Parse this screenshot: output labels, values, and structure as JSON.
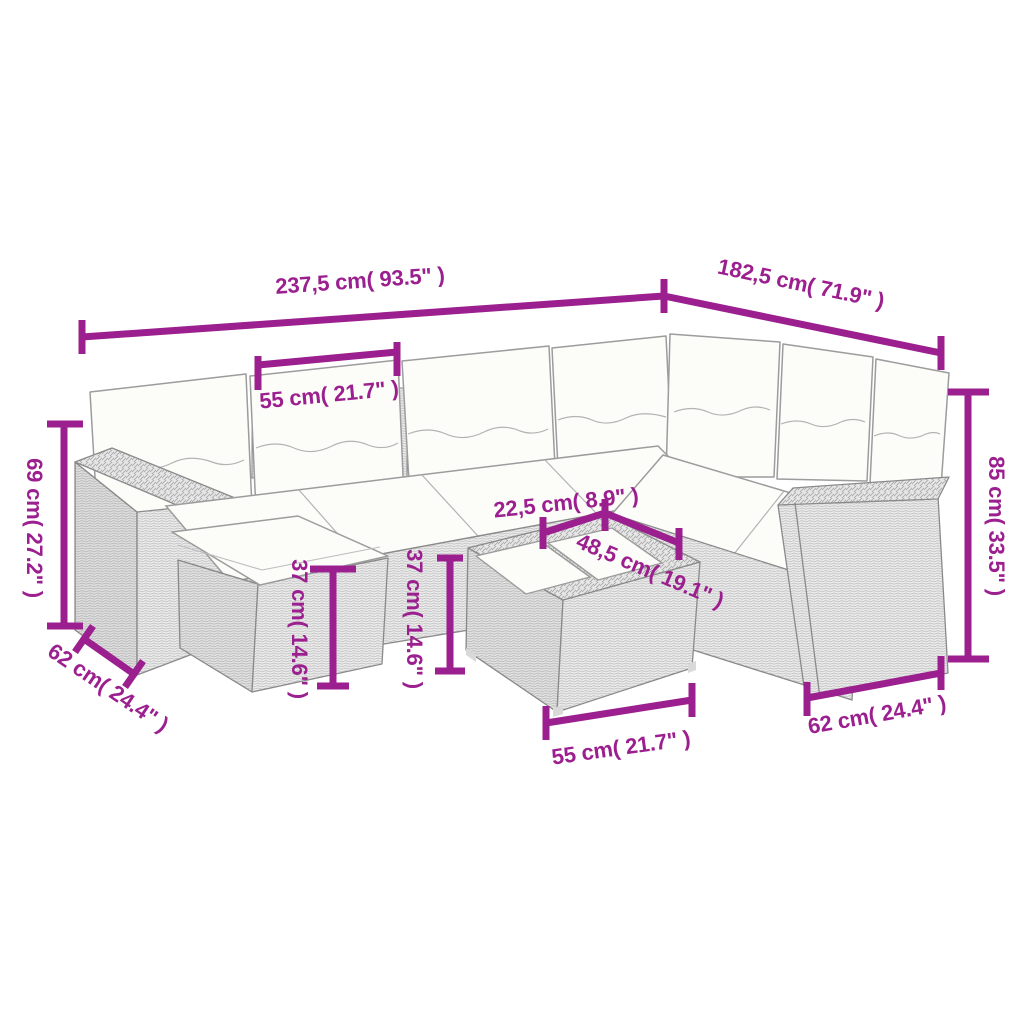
{
  "colors": {
    "accent": "#9b1f8e",
    "line_art_outline": "#8a8a8a",
    "cushion_fill": "#fcfcf9",
    "wicker_fill": "#ededed"
  },
  "dimensions": {
    "overall_width": "237,5 cm( 93.5\" )",
    "overall_depth": "182,5 cm( 71.9\" )",
    "backrest_section_width": "55 cm( 21.7\" )",
    "left_arm_height": "69 cm( 27.2\" )",
    "left_seat_depth": "62 cm( 24.4\" )",
    "footstool_height": "37 cm( 14.6\" )",
    "table_height": "37 cm( 14.6\" )",
    "tabletop_depth": "22,5 cm( 8.9\" )",
    "tabletop_width": "48,5 cm( 19.1\" )",
    "table_width": "55 cm( 21.7\" )",
    "right_back_height": "85 cm( 33.5\" )",
    "right_seat_depth": "62 cm( 24.4\" )"
  }
}
